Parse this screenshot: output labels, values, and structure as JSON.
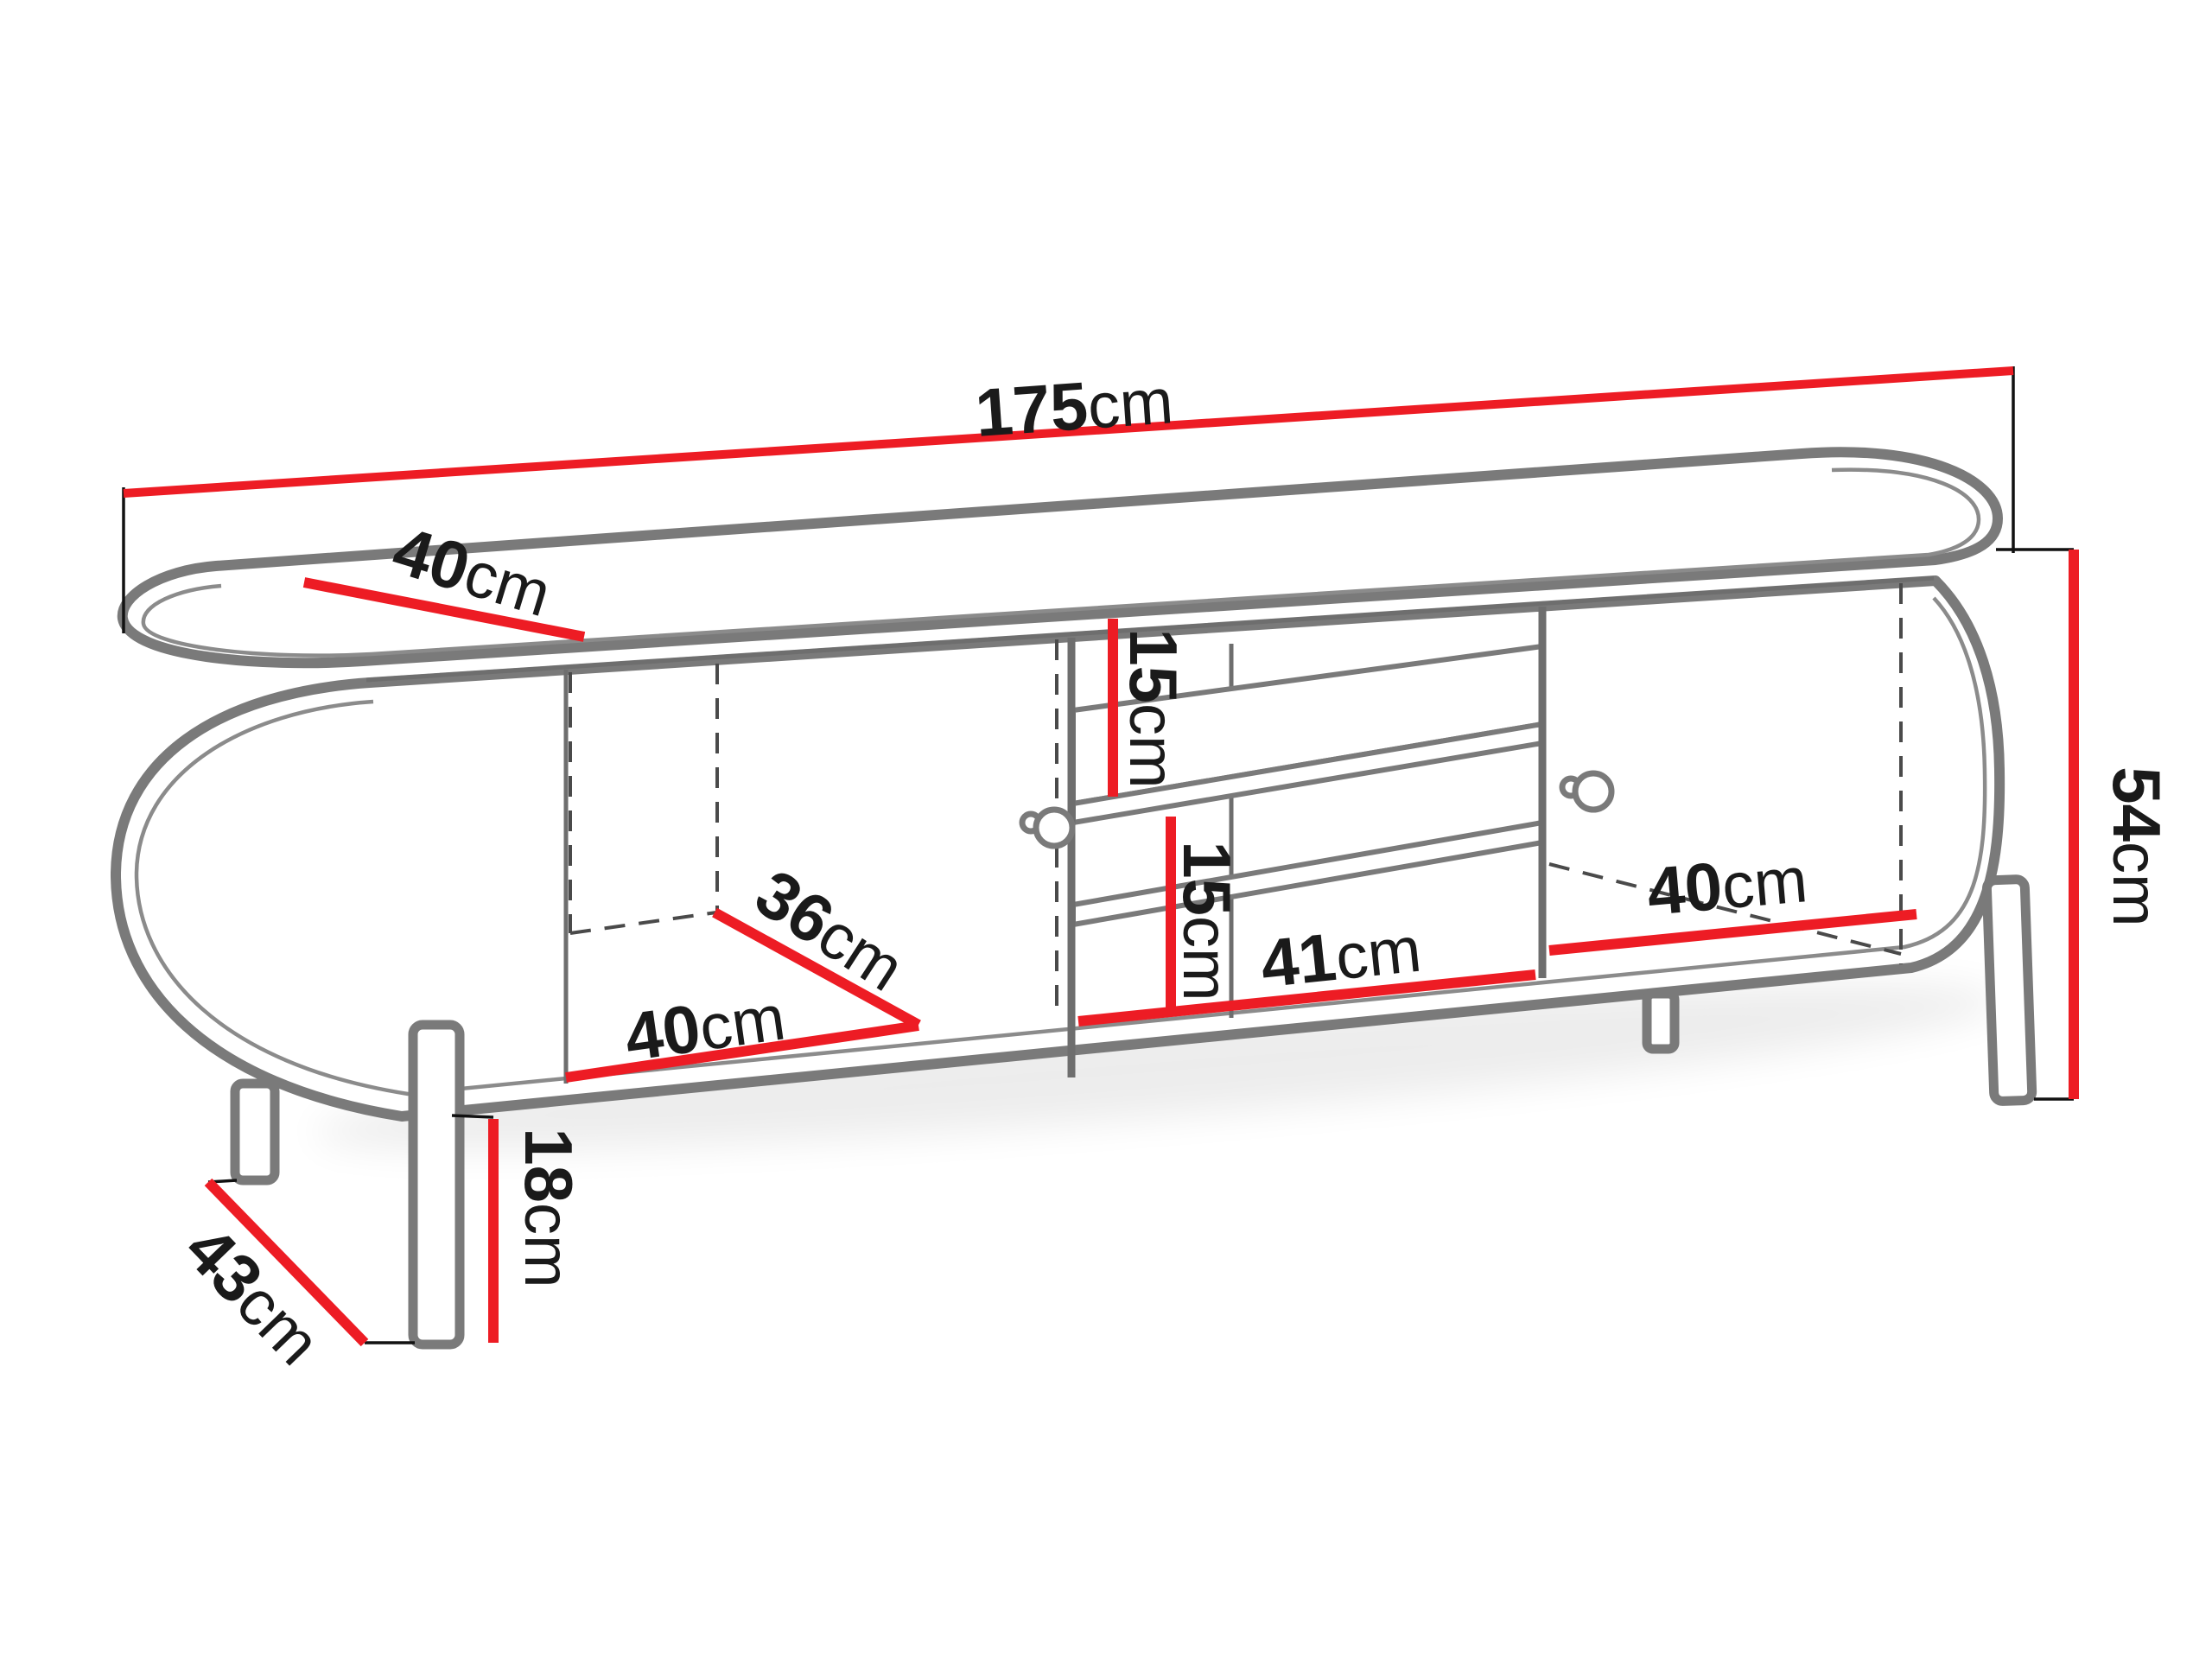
{
  "diagram": {
    "type": "furniture-dimension-drawing",
    "subject": "TV stand with two doors, open middle shelves and legs",
    "unit": "cm",
    "colors": {
      "dimension_line_red": "#ed1c24",
      "outline_gray": "#7a7a7a",
      "label_black": "#1a1a1a",
      "background": "#ffffff"
    },
    "dimensions": {
      "overall_width": {
        "num": "175",
        "unit": "cm",
        "value": 175
      },
      "overall_depth_top": {
        "num": "40",
        "unit": "cm",
        "value": 40
      },
      "overall_height": {
        "num": "54",
        "unit": "cm",
        "value": 54
      },
      "upper_shelf_gap": {
        "num": "15",
        "unit": "cm",
        "value": 15
      },
      "lower_shelf_gap": {
        "num": "15",
        "unit": "cm",
        "value": 15
      },
      "left_compartment_width": {
        "num": "40",
        "unit": "cm",
        "value": 40
      },
      "left_compartment_depth": {
        "num": "36",
        "unit": "cm",
        "value": 36
      },
      "middle_compartment_width": {
        "num": "41",
        "unit": "cm",
        "value": 41
      },
      "right_compartment_width": {
        "num": "40",
        "unit": "cm",
        "value": 40
      },
      "leg_height": {
        "num": "18",
        "unit": "cm",
        "value": 18
      },
      "leg_depth_span": {
        "num": "43",
        "unit": "cm",
        "value": 43
      }
    }
  }
}
